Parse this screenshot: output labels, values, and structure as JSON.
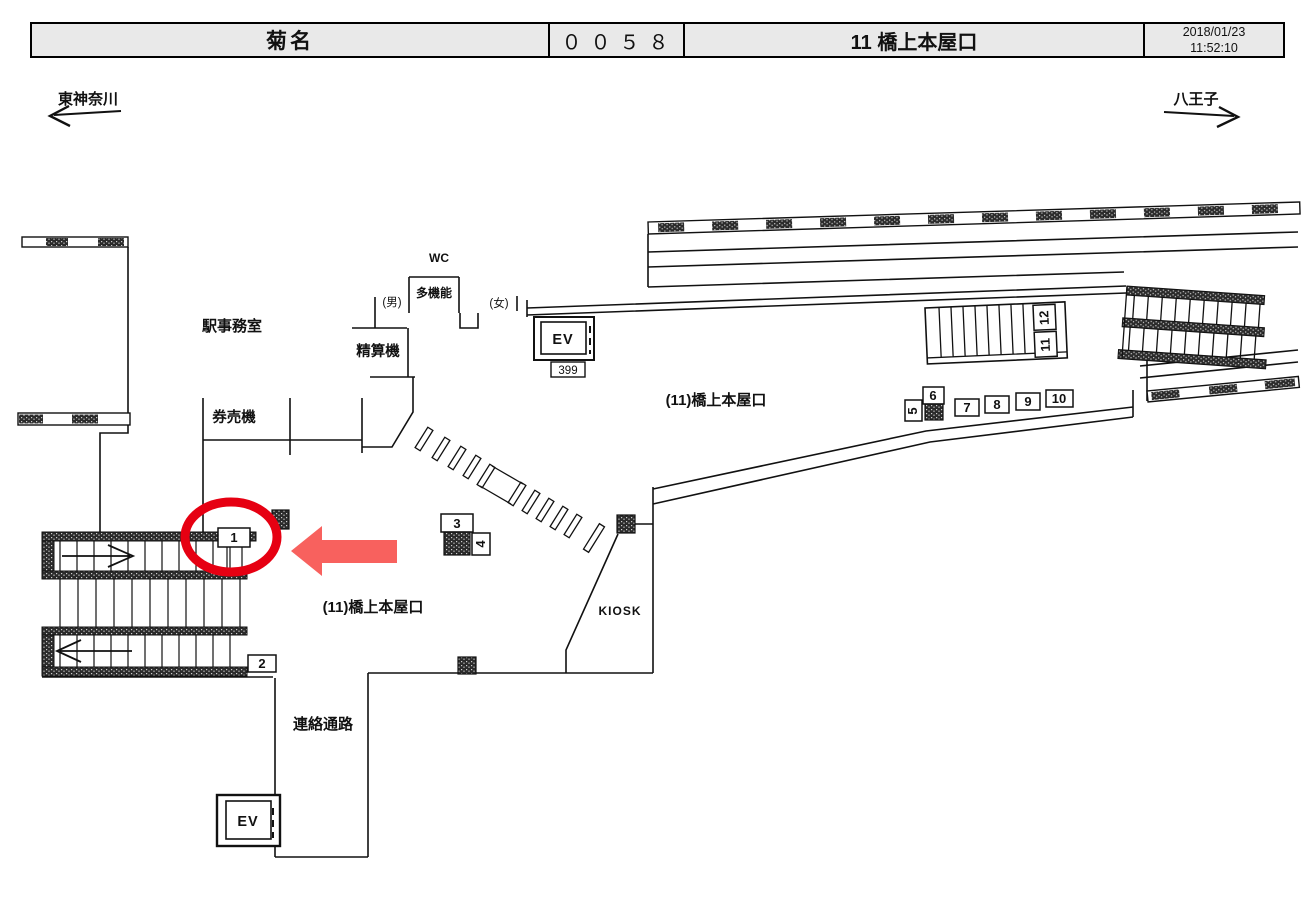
{
  "header": {
    "station": "菊名",
    "code": "００５８",
    "location": "11 橋上本屋口",
    "date": "2018/01/23",
    "time": "11:52:10"
  },
  "directions": {
    "left": "東神奈川",
    "right": "八王子"
  },
  "plan": {
    "labels": {
      "station_office": "駅事務室",
      "ticket_machines": "券売機",
      "fare_adjustment": "精算機",
      "wc": "WC",
      "multifunction": "多機能",
      "mens": "(男)",
      "womens": "(女)",
      "elevator_upper": "EV",
      "elevator_upper_number": "399",
      "elevator_lower": "EV",
      "concourse_right": "(11)橋上本屋口",
      "concourse_left": "(11)橋上本屋口",
      "kiosk": "KIOSK",
      "passage": "連絡通路"
    },
    "location_numbers": {
      "n1": "1",
      "n2": "2",
      "n3": "3",
      "n4": "4",
      "n5": "5",
      "n6": "6",
      "n7": "7",
      "n8": "8",
      "n9": "9",
      "n10": "10",
      "n11": "11",
      "n12": "12"
    },
    "colors": {
      "highlight_circle": "#e60012",
      "highlight_arrow": "#f8615e",
      "wall": "#111111",
      "header_bg": "#e9e9e9"
    }
  }
}
